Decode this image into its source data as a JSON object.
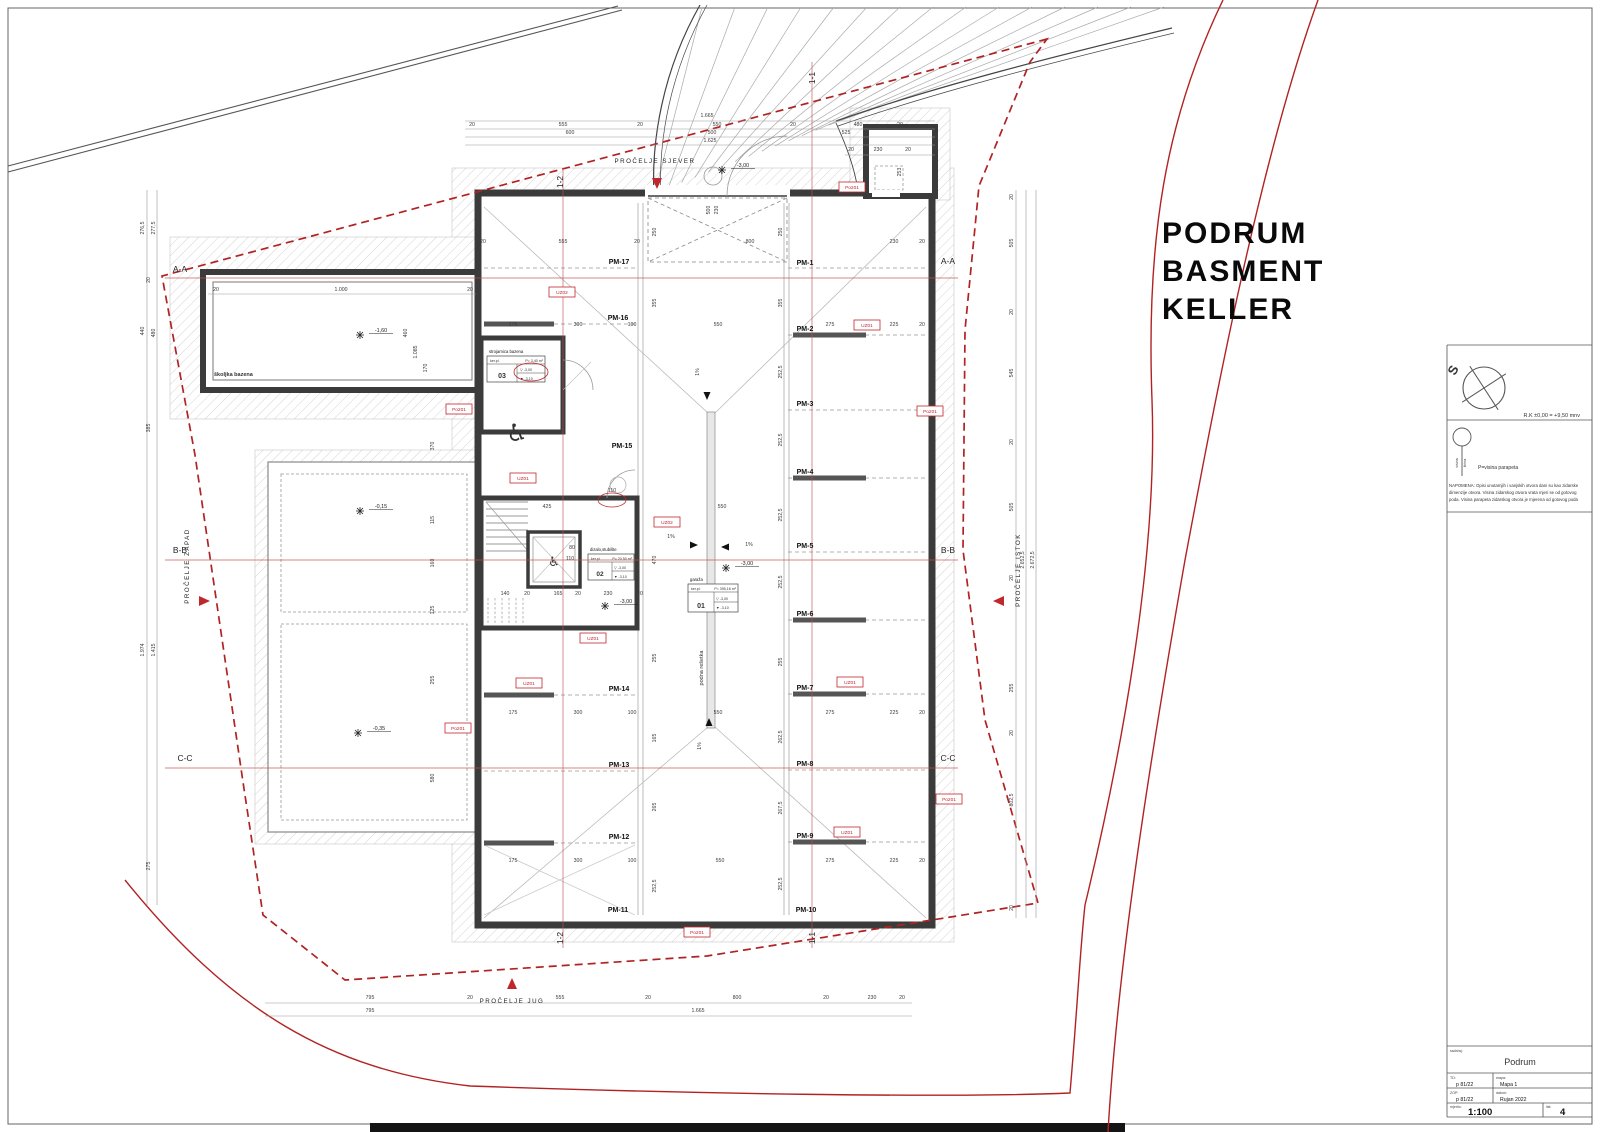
{
  "title": {
    "l1": "PODRUM",
    "l2": "BASMENT",
    "l3": "KELLER"
  },
  "legend": {
    "north_letter": "S",
    "datum_text": "R.K ±0,00 = +9,50 mnv",
    "parapet_text": "P=visina parapeta",
    "visina": "visina",
    "sirina": "širina",
    "note_lines": [
      "NAPOMENA: Opisi unutarnjih i vanjskih otvora dani su kao zidarske",
      "dimenzije otvora. Visina zidarskog  otvora vrata mjeri se od gotovog",
      "poda. Visina parapeta zidarskog otvora je mjerena od gotovog poda"
    ]
  },
  "titleblock": {
    "content_label": "sadržaj:",
    "content": "Podrum",
    "td_label": "TD:",
    "td": "p 81/22",
    "mapa_label": "mapa:",
    "mapa": "Mapa 1",
    "zop_label": "ZOP:",
    "zop": "p 81/22",
    "date_label": "datum:",
    "date": "Rujan 2022",
    "scale_label": "mjerilo:",
    "scale": "1:100",
    "sheet_label": "list:",
    "sheet": "4"
  },
  "rooms": {
    "pool_label": "školjka bazena",
    "grate_label": "podna rešetka",
    "accessible_icon": "♿",
    "r01": {
      "num": "01",
      "name": "garaža",
      "floor": "ker.pl.",
      "area": "P= 395,16 m²",
      "lvl1": "▽ -3,00",
      "lvl2": "▼ -3,10"
    },
    "r02": {
      "num": "02",
      "name": "dizalo,stubište",
      "floor": "ker.pl.",
      "area": "P= 20,50 m²",
      "lvl1": "▽ -3,00",
      "lvl2": "▼ -3,10"
    },
    "r03": {
      "num": "03",
      "name": "strojarnica bazena",
      "floor": "ker.pl.",
      "area": "P= 3,40 m²",
      "lvl1": "▽ -3,00",
      "lvl2": "▼ -3,10"
    }
  },
  "plan": {
    "parking": [
      {
        "t": "PM-1",
        "x": 805,
        "y": 265
      },
      {
        "t": "PM-2",
        "x": 805,
        "y": 331
      },
      {
        "t": "PM-3",
        "x": 805,
        "y": 406
      },
      {
        "t": "PM-4",
        "x": 805,
        "y": 474
      },
      {
        "t": "PM-5",
        "x": 805,
        "y": 548
      },
      {
        "t": "PM-6",
        "x": 805,
        "y": 616
      },
      {
        "t": "PM-7",
        "x": 805,
        "y": 690
      },
      {
        "t": "PM-8",
        "x": 805,
        "y": 766
      },
      {
        "t": "PM-9",
        "x": 805,
        "y": 838
      },
      {
        "t": "PM-10",
        "x": 806,
        "y": 912
      },
      {
        "t": "PM-11",
        "x": 618,
        "y": 912
      },
      {
        "t": "PM-12",
        "x": 619,
        "y": 839
      },
      {
        "t": "PM-13",
        "x": 619,
        "y": 767
      },
      {
        "t": "PM-14",
        "x": 619,
        "y": 691
      },
      {
        "t": "PM-15",
        "x": 622,
        "y": 448
      },
      {
        "t": "PM-16",
        "x": 618,
        "y": 320
      },
      {
        "t": "PM-17",
        "x": 619,
        "y": 264
      }
    ],
    "red_tags": [
      {
        "t": "Po201",
        "x": 852,
        "y": 187
      },
      {
        "t": "UZ02",
        "x": 562,
        "y": 292
      },
      {
        "t": "UZ01",
        "x": 867,
        "y": 325
      },
      {
        "t": "Po201",
        "x": 459,
        "y": 409
      },
      {
        "t": "Po201",
        "x": 930,
        "y": 411
      },
      {
        "t": "UZ01",
        "x": 523,
        "y": 478
      },
      {
        "t": "UZ02",
        "x": 667,
        "y": 522
      },
      {
        "t": "UZ01",
        "x": 593,
        "y": 638
      },
      {
        "t": "UZ01",
        "x": 529,
        "y": 683
      },
      {
        "t": "UZ01",
        "x": 850,
        "y": 682
      },
      {
        "t": "Po201",
        "x": 458,
        "y": 728
      },
      {
        "t": "Po201",
        "x": 949,
        "y": 799
      },
      {
        "t": "UZ01",
        "x": 847,
        "y": 832
      },
      {
        "t": "Po201",
        "x": 697,
        "y": 932
      }
    ],
    "levels": [
      {
        "t": "-3,00",
        "x": 733,
        "y": 167,
        "mx": 722,
        "my": 170
      },
      {
        "t": "-1,60",
        "x": 371,
        "y": 332,
        "mx": 360,
        "my": 335
      },
      {
        "t": "-0,15",
        "x": 371,
        "y": 508,
        "mx": 360,
        "my": 511
      },
      {
        "t": "-0,35",
        "x": 369,
        "y": 730,
        "mx": 358,
        "my": 733
      },
      {
        "t": "-3,00",
        "x": 616,
        "y": 603,
        "mx": 605,
        "my": 606
      },
      {
        "t": "-3,00",
        "x": 737,
        "y": 565,
        "mx": 726,
        "my": 568
      }
    ],
    "slopes": [
      {
        "t": "1%",
        "x": 699,
        "y": 372,
        "r": 1,
        "ax": 707,
        "ay": 392,
        "dir": "down"
      },
      {
        "t": "1%",
        "x": 671,
        "y": 538,
        "r": 0,
        "ax": 690,
        "ay": 545,
        "dir": "right"
      },
      {
        "t": "1%",
        "x": 749,
        "y": 546,
        "r": 0,
        "ax": 729,
        "ay": 547,
        "dir": "left"
      },
      {
        "t": "1%",
        "x": 701,
        "y": 746,
        "r": 1,
        "ax": 709,
        "ay": 726,
        "dir": "up"
      }
    ],
    "facades": [
      {
        "t": "PROČELJE SJEVER",
        "x": 655,
        "y": 163,
        "r": 0,
        "tx": 657,
        "ty": 178,
        "dir": "down"
      },
      {
        "t": "PROČELJE ZAPAD",
        "x": 189,
        "y": 566,
        "r": 1,
        "tx": 199,
        "ty": 601,
        "dir": "right"
      },
      {
        "t": "PROČELJE ISTOK",
        "x": 1020,
        "y": 570,
        "r": 1,
        "tx": 1004,
        "ty": 601,
        "dir": "left"
      },
      {
        "t": "PROČELJE JUG",
        "x": 512,
        "y": 1003,
        "r": 0,
        "tx": 512,
        "ty": 989,
        "dir": "up"
      }
    ],
    "section_labels": [
      {
        "t": "A-A",
        "x": 180,
        "y": 272,
        "r": 0
      },
      {
        "t": "A-A",
        "x": 948,
        "y": 264,
        "r": 0
      },
      {
        "t": "B-B",
        "x": 180,
        "y": 553,
        "r": 0
      },
      {
        "t": "B-B",
        "x": 948,
        "y": 553,
        "r": 0
      },
      {
        "t": "C-C",
        "x": 185,
        "y": 761,
        "r": 0
      },
      {
        "t": "C-C",
        "x": 948,
        "y": 761,
        "r": 0
      },
      {
        "t": "1-2",
        "x": 563,
        "y": 182,
        "r": 1
      },
      {
        "t": "1-1",
        "x": 815,
        "y": 78,
        "r": 1
      },
      {
        "t": "1-2",
        "x": 563,
        "y": 938,
        "r": 1
      },
      {
        "t": "1-1",
        "x": 815,
        "y": 938,
        "r": 1
      }
    ],
    "dims": [
      {
        "t": "1.665",
        "x": 707,
        "y": 117
      },
      {
        "t": "20",
        "x": 472,
        "y": 126
      },
      {
        "t": "555",
        "x": 563,
        "y": 126
      },
      {
        "t": "20",
        "x": 640,
        "y": 126
      },
      {
        "t": "550",
        "x": 717,
        "y": 126
      },
      {
        "t": "20",
        "x": 793,
        "y": 126
      },
      {
        "t": "480",
        "x": 858,
        "y": 126
      },
      {
        "t": "20",
        "x": 900,
        "y": 126
      },
      {
        "t": "600",
        "x": 570,
        "y": 134
      },
      {
        "t": "500",
        "x": 712,
        "y": 134
      },
      {
        "t": "525",
        "x": 846,
        "y": 134
      },
      {
        "t": "1.625",
        "x": 710,
        "y": 142
      },
      {
        "t": "20",
        "x": 851,
        "y": 151
      },
      {
        "t": "230",
        "x": 878,
        "y": 151
      },
      {
        "t": "20",
        "x": 908,
        "y": 151
      },
      {
        "t": "253",
        "x": 901,
        "y": 172,
        "r": 1
      },
      {
        "t": "500",
        "x": 710,
        "y": 210,
        "r": 1
      },
      {
        "t": "230",
        "x": 718,
        "y": 210,
        "r": 1
      },
      {
        "t": "795",
        "x": 370,
        "y": 999
      },
      {
        "t": "20",
        "x": 470,
        "y": 999
      },
      {
        "t": "555",
        "x": 560,
        "y": 999
      },
      {
        "t": "20",
        "x": 648,
        "y": 999
      },
      {
        "t": "800",
        "x": 737,
        "y": 999
      },
      {
        "t": "20",
        "x": 826,
        "y": 999
      },
      {
        "t": "230",
        "x": 872,
        "y": 999
      },
      {
        "t": "20",
        "x": 902,
        "y": 999
      },
      {
        "t": "795",
        "x": 370,
        "y": 1012
      },
      {
        "t": "1.665",
        "x": 698,
        "y": 1012
      },
      {
        "t": "276,5",
        "x": 144,
        "y": 228,
        "r": 1
      },
      {
        "t": "277,5",
        "x": 155,
        "y": 228,
        "r": 1
      },
      {
        "t": "20",
        "x": 150,
        "y": 280,
        "r": 1
      },
      {
        "t": "440",
        "x": 144,
        "y": 331,
        "r": 1
      },
      {
        "t": "480",
        "x": 155,
        "y": 333,
        "r": 1
      },
      {
        "t": "385",
        "x": 150,
        "y": 428,
        "r": 1
      },
      {
        "t": "1.974",
        "x": 144,
        "y": 650,
        "r": 1
      },
      {
        "t": "1.415",
        "x": 155,
        "y": 650,
        "r": 1
      },
      {
        "t": "275",
        "x": 150,
        "y": 866,
        "r": 1
      },
      {
        "t": "20",
        "x": 1013,
        "y": 197,
        "r": 1
      },
      {
        "t": "505",
        "x": 1013,
        "y": 243,
        "r": 1
      },
      {
        "t": "20",
        "x": 1013,
        "y": 312,
        "r": 1
      },
      {
        "t": "545",
        "x": 1013,
        "y": 373,
        "r": 1
      },
      {
        "t": "20",
        "x": 1013,
        "y": 442,
        "r": 1
      },
      {
        "t": "505",
        "x": 1013,
        "y": 507,
        "r": 1
      },
      {
        "t": "20",
        "x": 1013,
        "y": 578,
        "r": 1
      },
      {
        "t": "255",
        "x": 1013,
        "y": 688,
        "r": 1
      },
      {
        "t": "20",
        "x": 1013,
        "y": 733,
        "r": 1
      },
      {
        "t": "802,5",
        "x": 1013,
        "y": 800,
        "r": 1
      },
      {
        "t": "20",
        "x": 1013,
        "y": 908,
        "r": 1
      },
      {
        "t": "2.652,5",
        "x": 1024,
        "y": 560,
        "r": 1
      },
      {
        "t": "2.672,5",
        "x": 1034,
        "y": 560,
        "r": 1
      },
      {
        "t": "20",
        "x": 483,
        "y": 243
      },
      {
        "t": "555",
        "x": 563,
        "y": 243
      },
      {
        "t": "20",
        "x": 637,
        "y": 243
      },
      {
        "t": "800",
        "x": 750,
        "y": 243
      },
      {
        "t": "230",
        "x": 894,
        "y": 243
      },
      {
        "t": "20",
        "x": 922,
        "y": 243
      },
      {
        "t": "175",
        "x": 513,
        "y": 326
      },
      {
        "t": "300",
        "x": 578,
        "y": 326
      },
      {
        "t": "100",
        "x": 632,
        "y": 326
      },
      {
        "t": "550",
        "x": 718,
        "y": 326
      },
      {
        "t": "275",
        "x": 830,
        "y": 326
      },
      {
        "t": "225",
        "x": 894,
        "y": 326
      },
      {
        "t": "20",
        "x": 922,
        "y": 326
      },
      {
        "t": "425",
        "x": 547,
        "y": 508
      },
      {
        "t": "550",
        "x": 722,
        "y": 508
      },
      {
        "t": "140",
        "x": 505,
        "y": 595
      },
      {
        "t": "20",
        "x": 527,
        "y": 595
      },
      {
        "t": "165",
        "x": 558,
        "y": 595
      },
      {
        "t": "20",
        "x": 578,
        "y": 595
      },
      {
        "t": "230",
        "x": 608,
        "y": 595
      },
      {
        "t": "20",
        "x": 640,
        "y": 595
      },
      {
        "t": "175",
        "x": 513,
        "y": 714
      },
      {
        "t": "300",
        "x": 578,
        "y": 714
      },
      {
        "t": "100",
        "x": 632,
        "y": 714
      },
      {
        "t": "550",
        "x": 718,
        "y": 714
      },
      {
        "t": "275",
        "x": 830,
        "y": 714
      },
      {
        "t": "225",
        "x": 894,
        "y": 714
      },
      {
        "t": "20",
        "x": 922,
        "y": 714
      },
      {
        "t": "175",
        "x": 513,
        "y": 862
      },
      {
        "t": "300",
        "x": 578,
        "y": 862
      },
      {
        "t": "100",
        "x": 632,
        "y": 862
      },
      {
        "t": "550",
        "x": 720,
        "y": 862
      },
      {
        "t": "275",
        "x": 830,
        "y": 862
      },
      {
        "t": "225",
        "x": 894,
        "y": 862
      },
      {
        "t": "20",
        "x": 922,
        "y": 862
      },
      {
        "t": "250",
        "x": 656,
        "y": 232,
        "r": 1
      },
      {
        "t": "355",
        "x": 656,
        "y": 303,
        "r": 1
      },
      {
        "t": "470",
        "x": 656,
        "y": 560,
        "r": 1
      },
      {
        "t": "255",
        "x": 656,
        "y": 658,
        "r": 1
      },
      {
        "t": "165",
        "x": 656,
        "y": 738,
        "r": 1
      },
      {
        "t": "265",
        "x": 656,
        "y": 807,
        "r": 1
      },
      {
        "t": "252,5",
        "x": 656,
        "y": 886,
        "r": 1
      },
      {
        "t": "250",
        "x": 782,
        "y": 232,
        "r": 1
      },
      {
        "t": "355",
        "x": 782,
        "y": 303,
        "r": 1
      },
      {
        "t": "252,5",
        "x": 782,
        "y": 372,
        "r": 1
      },
      {
        "t": "252,5",
        "x": 782,
        "y": 440,
        "r": 1
      },
      {
        "t": "252,5",
        "x": 782,
        "y": 515,
        "r": 1
      },
      {
        "t": "252,5",
        "x": 782,
        "y": 582,
        "r": 1
      },
      {
        "t": "255",
        "x": 782,
        "y": 662,
        "r": 1
      },
      {
        "t": "262,5",
        "x": 782,
        "y": 737,
        "r": 1
      },
      {
        "t": "267,5",
        "x": 782,
        "y": 808,
        "r": 1
      },
      {
        "t": "252,5",
        "x": 782,
        "y": 884,
        "r": 1
      },
      {
        "t": "20",
        "x": 216,
        "y": 291
      },
      {
        "t": "1.000",
        "x": 341,
        "y": 291
      },
      {
        "t": "20",
        "x": 470,
        "y": 291
      },
      {
        "t": "460",
        "x": 407,
        "y": 333,
        "r": 1
      },
      {
        "t": "1.085",
        "x": 417,
        "y": 352,
        "r": 1
      },
      {
        "t": "170",
        "x": 427,
        "y": 368,
        "r": 1
      },
      {
        "t": "370",
        "x": 434,
        "y": 446,
        "r": 1
      },
      {
        "t": "115",
        "x": 434,
        "y": 520,
        "r": 1
      },
      {
        "t": "160",
        "x": 434,
        "y": 563,
        "r": 1
      },
      {
        "t": "125",
        "x": 434,
        "y": 610,
        "r": 1
      },
      {
        "t": "255",
        "x": 434,
        "y": 680,
        "r": 1
      },
      {
        "t": "580",
        "x": 434,
        "y": 778,
        "r": 1
      },
      {
        "t": "80",
        "x": 572,
        "y": 549
      },
      {
        "t": "110",
        "x": 570,
        "y": 560
      },
      {
        "t": "110",
        "x": 612,
        "y": 492
      }
    ]
  },
  "colors": {
    "red": "#c0272d",
    "wall": "#3b3b3b",
    "dim_line": "#999999",
    "hatch": "#c9c9ce"
  }
}
